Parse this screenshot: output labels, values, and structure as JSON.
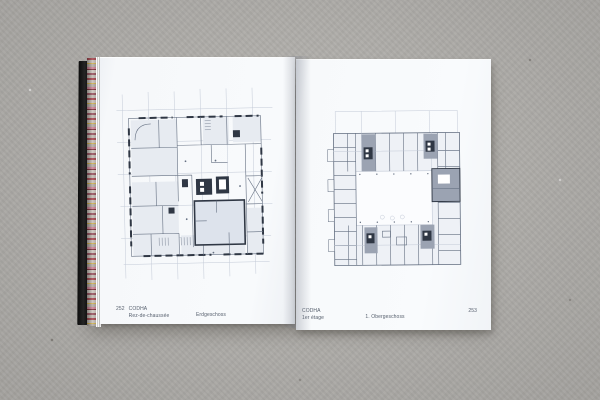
{
  "colors": {
    "bg": "#b4b2ae",
    "cover": "#141414",
    "paper": "#f7f9fb",
    "ink": "#57606e",
    "plan_dark": "#2f3744",
    "plan_mid": "#657082",
    "plan_faint": "#c3cad7",
    "plan_fill": "#e7ebf1",
    "plan_gray": "#9ba3b2",
    "courtyard": "#fbfcfe",
    "fore_red": "#a84750",
    "fore_yellow": "#d2b24e",
    "fore_pink": "#cf8496"
  },
  "book": {
    "left_page": {
      "page_number": "252",
      "project": "CODHA",
      "caption_primary": "Rez-de-chaussée",
      "caption_secondary": "Erdgeschoss"
    },
    "right_page": {
      "project": "CODHA",
      "caption_primary": "1er étage",
      "caption_secondary": "1. Obergeschoss",
      "page_number": "253"
    }
  }
}
